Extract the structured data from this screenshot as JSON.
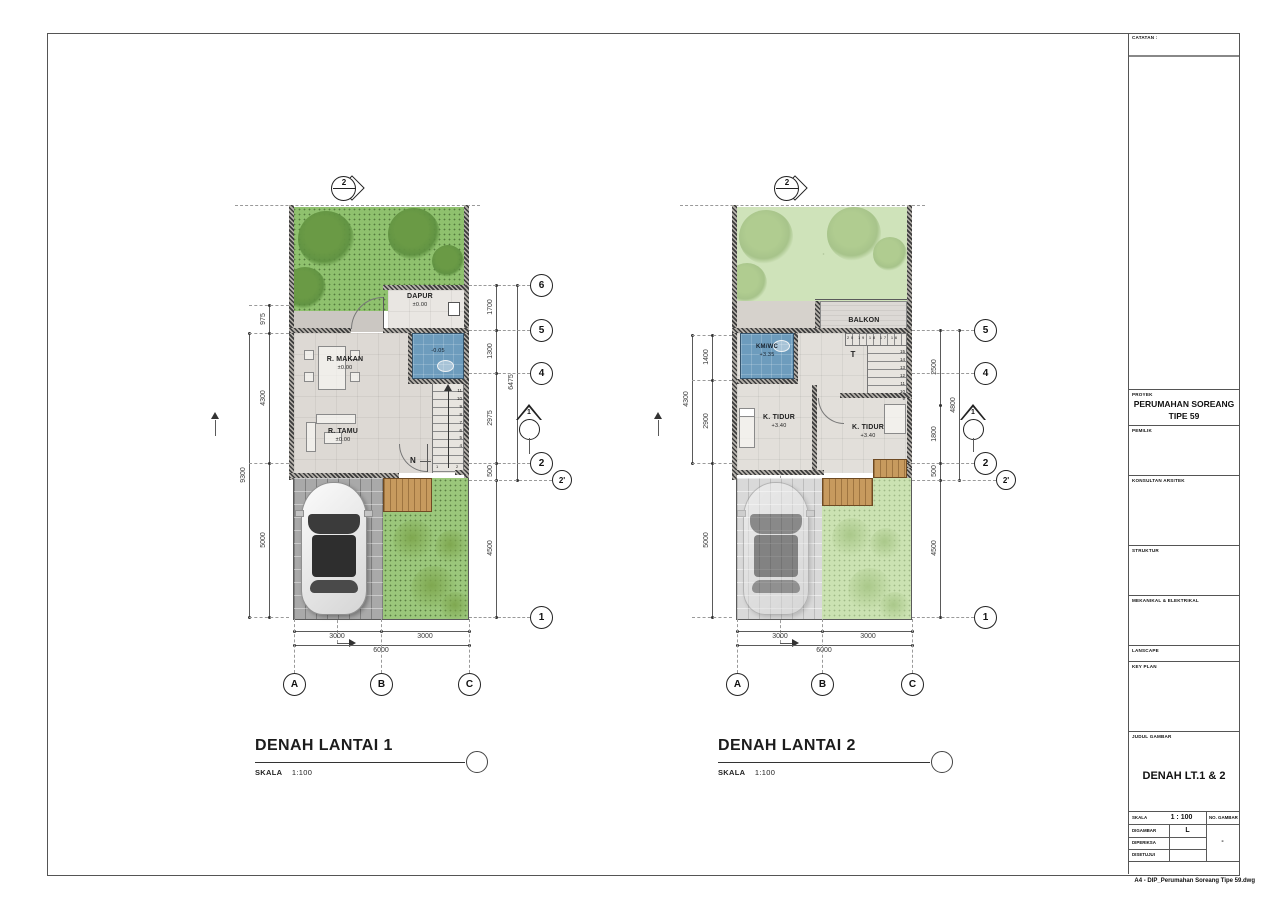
{
  "colors": {
    "garden_l1": "#8fc16e",
    "tree_l1": "#6a9a45",
    "garden_l2": "#cfe3ba",
    "tree_l2": "#b0cc90",
    "yard_l1": "#9bc77b",
    "shrub_l1": "#7fa850",
    "yard_l2": "#cbe2b2",
    "shrub_l2": "#aac88a",
    "wet_room": "#6d9cbd",
    "wood_deck": "#c79a5e",
    "paver": "#a9a9a9",
    "paver_faded": "#d9d9d9",
    "floor": "#ddd9d4",
    "floor_light": "#e9e6e2",
    "wall": "#3c3c3c",
    "line": "#555555"
  },
  "plans": {
    "p1": {
      "title": "DENAH LANTAI 1",
      "scale_label": "SKALA",
      "scale_value": "1:100",
      "section_top_label": "2",
      "section_side_label": "1",
      "stair_direction_label": "N",
      "stair_numbers": [
        "11",
        "10",
        "9",
        "8",
        "7",
        "6",
        "5",
        "4"
      ],
      "stair_start_1": "1",
      "stair_start_2": "2",
      "rooms": {
        "dapur_name": "DAPUR",
        "dapur_elev": "±0.00",
        "makan_name": "R. MAKAN",
        "makan_elev": "±0.00",
        "tamu_name": "R. TAMU",
        "tamu_elev": "±0.00",
        "kmwc_elev": "-0.05"
      },
      "dims": {
        "left": [
          "975",
          "4300",
          "5000"
        ],
        "left_total": "9300",
        "right": [
          "1700",
          "1300",
          "2975",
          "500",
          "4500"
        ],
        "right_total": "6475",
        "bottom": [
          "3000",
          "3000"
        ],
        "bottom_total": "6000"
      },
      "grid_rows": [
        "6",
        "5",
        "4",
        "2",
        "2'",
        "1"
      ],
      "grid_cols": [
        "A",
        "B",
        "C"
      ]
    },
    "p2": {
      "title": "DENAH LANTAI 2",
      "scale_label": "SKALA",
      "scale_value": "1:100",
      "section_top_label": "2",
      "section_side_label": "1",
      "stair_direction_label": "T",
      "stair_numbers": [
        "15",
        "14",
        "13",
        "12",
        "11",
        "10",
        "9"
      ],
      "stair_top_numbers": "20 19 18 17 16",
      "rooms": {
        "balkon_name": "BALKON",
        "kmwc_name": "KM/WC",
        "kmwc_elev": "+3.35",
        "tidur1_name": "K. TIDUR",
        "tidur1_elev": "+3.40",
        "tidur2_name": "K. TIDUR",
        "tidur2_elev": "+3.40"
      },
      "dims": {
        "left": [
          "1400",
          "2900",
          "5000"
        ],
        "left_total": "4300",
        "right": [
          "2500",
          "1800",
          "500",
          "4500"
        ],
        "right_total": "4800",
        "bottom": [
          "3000",
          "3000"
        ],
        "bottom_total": "6000"
      },
      "grid_rows": [
        "5",
        "4",
        "2",
        "2'",
        "1"
      ],
      "grid_cols": [
        "A",
        "B",
        "C"
      ]
    }
  },
  "titleblock": {
    "catatan_label": "CATATAN :",
    "proyek_label": "PROYEK",
    "proyek_value_line1": "PERUMAHAN SOREANG",
    "proyek_value_line2": "TIPE 59",
    "pemilik_label": "PEMILIK",
    "konsultan_label": "KONSULTAN ARSITEK",
    "struktur_label": "STRUKTUR",
    "mekanikal_label": "MEKANIKAL & ELEKTRIKAL",
    "lanscape_label": "LANSCAPE",
    "keyplan_label": "KEY PLAN",
    "judul_label": "JUDUL GAMBAR",
    "judul_value": "DENAH LT.1 & 2",
    "skala_label": "SKALA",
    "skala_value": "1 : 100",
    "no_gambar_label": "NO. GAMBAR",
    "no_gambar_value": "-",
    "digambar_label": "DIGAMBAR",
    "digambar_value": "L",
    "diperiksa_label": "DIPERIKSA",
    "disetujui_label": "DISETUJUI",
    "footer_text": "A4 - DIP_Perumahan Soreang Tipe 59.dwg"
  }
}
